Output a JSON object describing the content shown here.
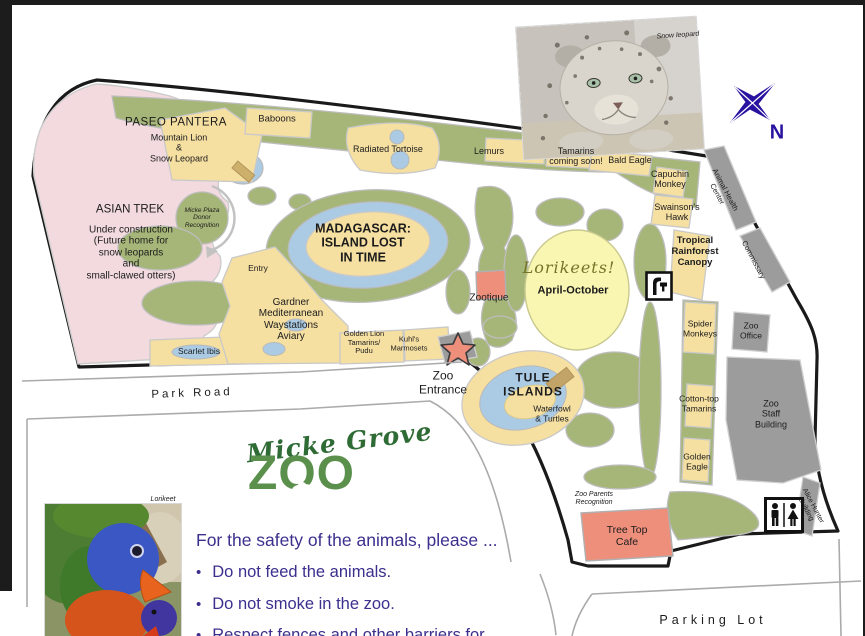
{
  "page_title": "Micke Grove Zoo map",
  "map": {
    "labels": [
      {
        "id": "label-paseo-pantera",
        "text": "PASEO PANTERA",
        "x": 176,
        "y": 123,
        "size": 11.5,
        "ls": 0.5
      },
      {
        "id": "label-mountain-lion-snow-leopard",
        "text": "Mountain Lion\n&\nSnow Leopard",
        "x": 179,
        "y": 148,
        "size": 9
      },
      {
        "id": "label-baboons",
        "text": "Baboons",
        "x": 277,
        "y": 120,
        "size": 9.5
      },
      {
        "id": "label-asian-trek",
        "text": "ASIAN TREK",
        "x": 130,
        "y": 210,
        "size": 11.5
      },
      {
        "id": "label-asian-trek-sub",
        "text": "Under construction\n(Future home for\nsnow leopards\nand\nsmall-clawed otters)",
        "x": 131,
        "y": 253,
        "size": 10
      },
      {
        "id": "label-micke-plaza",
        "text": "Micke Plaza\nDonor\nRecognition",
        "x": 202,
        "y": 218,
        "size": 6.5,
        "italic": true
      },
      {
        "id": "label-madagascar",
        "text": "MADAGASCAR:\nISLAND LOST\nIN TIME",
        "x": 363,
        "y": 243,
        "size": 12.5,
        "weight": 600
      },
      {
        "id": "label-radiated-tortoise",
        "text": "Radiated Tortoise",
        "x": 388,
        "y": 149,
        "size": 9
      },
      {
        "id": "label-lemurs",
        "text": "Lemurs",
        "x": 489,
        "y": 151,
        "size": 9
      },
      {
        "id": "label-tamarins",
        "text": "Tamarins\ncoming soon!",
        "x": 576,
        "y": 156,
        "size": 9
      },
      {
        "id": "label-bald-eagle",
        "text": "Bald Eagle",
        "x": 630,
        "y": 160,
        "size": 9
      },
      {
        "id": "label-capuchin-monkey",
        "text": "Capuchin\nMonkey",
        "x": 670,
        "y": 179,
        "size": 9
      },
      {
        "id": "label-swainsons-hawk",
        "text": "Swainson's\nHawk",
        "x": 677,
        "y": 212,
        "size": 9
      },
      {
        "id": "label-tropical-rainforest-canopy",
        "text": "Tropical\nRainforest\nCanopy",
        "x": 695,
        "y": 252,
        "size": 9.5,
        "weight": 700
      },
      {
        "id": "label-animal-health-center",
        "text": "Animal Health\nCenter",
        "x": 721,
        "y": 192,
        "size": 7.5,
        "rotate": 62
      },
      {
        "id": "label-commissary",
        "text": "Commissary",
        "x": 753,
        "y": 260,
        "size": 7.5,
        "rotate": 62
      },
      {
        "id": "label-lorikeets",
        "text": "Lorikeets!",
        "x": 569,
        "y": 268,
        "size": 16,
        "italic": true,
        "serif": true,
        "color": "#75752a",
        "ls": 1
      },
      {
        "id": "label-april-october",
        "text": "April-October",
        "x": 573,
        "y": 291,
        "size": 11,
        "weight": 600
      },
      {
        "id": "label-zootique",
        "text": "Zootique",
        "x": 489,
        "y": 298,
        "size": 10
      },
      {
        "id": "label-entry",
        "text": "Entry",
        "x": 258,
        "y": 269,
        "size": 8.5
      },
      {
        "id": "label-gardner-aviary",
        "text": "Gardner\nMediterranean\nWaystations\nAviary",
        "x": 291,
        "y": 320,
        "size": 10
      },
      {
        "id": "label-scarlet-ibis",
        "text": "Scarlet Ibis",
        "x": 199,
        "y": 352,
        "size": 8.5
      },
      {
        "id": "label-golden-lion-tamarins",
        "text": "Golden Lion\nTamarins/\nPudu",
        "x": 364,
        "y": 343,
        "size": 7.5
      },
      {
        "id": "label-kuhls-marmosets",
        "text": "Kuhl's\nMarmosets",
        "x": 409,
        "y": 344,
        "size": 7.5
      },
      {
        "id": "label-zoo-entrance",
        "text": "Zoo\nEntrance",
        "x": 443,
        "y": 383,
        "size": 12
      },
      {
        "id": "label-tule-islands",
        "text": "TULE\nISLANDS",
        "x": 533,
        "y": 385,
        "size": 12,
        "weight": 600,
        "ls": 1
      },
      {
        "id": "label-waterfowl-turtles",
        "text": "Waterfowl\n& Turtles",
        "x": 552,
        "y": 414,
        "size": 8.5
      },
      {
        "id": "label-spider-monkeys",
        "text": "Spider\nMonkeys",
        "x": 700,
        "y": 329,
        "size": 8.5
      },
      {
        "id": "label-zoo-office",
        "text": "Zoo\nOffice",
        "x": 751,
        "y": 331,
        "size": 8.5
      },
      {
        "id": "label-cotton-top-tamarins",
        "text": "Cotton-top\nTamarins",
        "x": 699,
        "y": 404,
        "size": 8.5
      },
      {
        "id": "label-zoo-staff-building",
        "text": "Zoo\nStaff\nBuilding",
        "x": 771,
        "y": 414,
        "size": 9
      },
      {
        "id": "label-golden-eagle",
        "text": "Golden\nEagle",
        "x": 697,
        "y": 462,
        "size": 8.5
      },
      {
        "id": "label-alice-hunter-building",
        "text": "Alice Hunter\nBuilding",
        "x": 809,
        "y": 508,
        "size": 7,
        "rotate": 62
      },
      {
        "id": "label-zoo-parents-recognition",
        "text": "Zoo Parents\nRecognition",
        "x": 594,
        "y": 499,
        "size": 7,
        "italic": true
      },
      {
        "id": "label-tree-top-cafe",
        "text": "Tree Top\nCafe",
        "x": 627,
        "y": 537,
        "size": 10.5
      },
      {
        "id": "label-park-road",
        "text": "Park Road",
        "x": 192,
        "y": 394,
        "size": 11.5,
        "ls": 3,
        "rotate": -2
      },
      {
        "id": "label-parking-lot",
        "text": "Parking Lot",
        "x": 713,
        "y": 620,
        "size": 12.5,
        "ls": 4
      },
      {
        "id": "label-snow-leopard-caption",
        "text": "Snow leopard",
        "x": 678,
        "y": 36,
        "size": 7,
        "italic": true,
        "rotate": -4
      },
      {
        "id": "label-lorikeet-caption",
        "text": "Lorikeet",
        "x": 163,
        "y": 500,
        "size": 7,
        "italic": true
      }
    ],
    "icons": [
      {
        "id": "restroom-icon",
        "meaning": "restrooms (men and women)"
      },
      {
        "id": "drinking-fountain-icon",
        "meaning": "drinking fountain"
      },
      {
        "id": "entrance-star-icon",
        "meaning": "zoo entrance star marker"
      },
      {
        "id": "donor-arrow-icon",
        "meaning": "curved path arrow around Micke Plaza"
      }
    ]
  },
  "compass": {
    "label": "N"
  },
  "logo": {
    "script": "Micke Grove",
    "zoo": "ZOO"
  },
  "legend": {
    "heading": "For the safety of the animals, please ...",
    "bullets": [
      "Do not feed the animals.",
      "Do not smoke in the zoo.",
      "Respect fences and other barriers for"
    ]
  },
  "colors": {
    "map_green": "#a6b678",
    "exhibit_yellow": "#f5dfa1",
    "water_blue": "#abcbe4",
    "asian_trek_pink": "#f2dade",
    "building_gray": "#9c9c9c",
    "cafe_salmon": "#ee8f7c",
    "lorikeet_area_yellow": "#f9f6b2",
    "text_purple": "#3c2f8e",
    "compass_purple": "#2a12a0",
    "outline_black": "#1a1a1a"
  }
}
